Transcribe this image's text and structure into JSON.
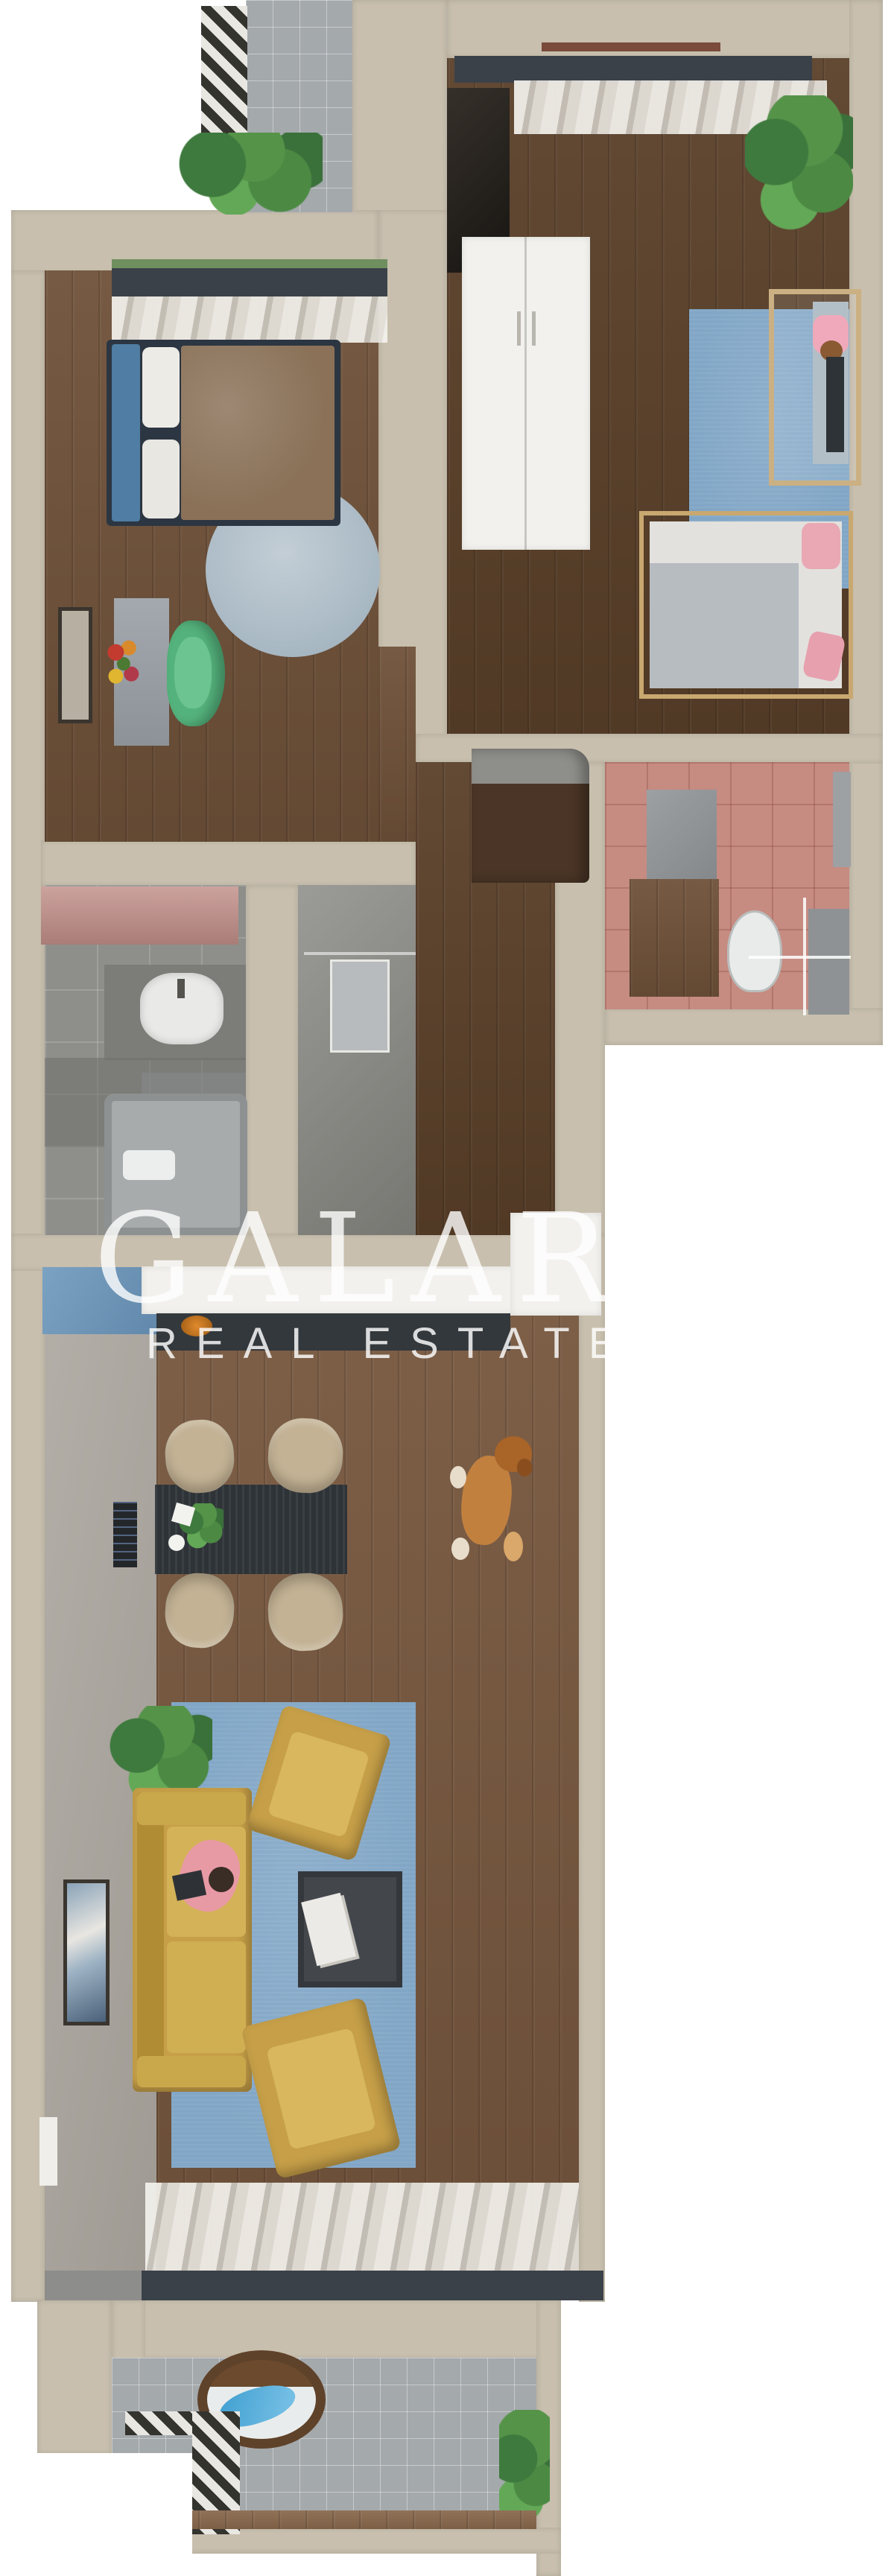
{
  "watermark": {
    "brand": "GALARDO",
    "tagline": "REAL ESTATE"
  },
  "palette": {
    "background": "#ffffff",
    "wall_beige": "#c8bfae",
    "wood_floor": "#6f5139",
    "wood_floor_dark": "#5a4029",
    "tile_gray": "#a4a9ac",
    "bathroom_pink": "#c68b81",
    "rug_blue": "#81a6c6",
    "sofa_mustard": "#c69f48",
    "window_frame_dark": "#3a4149",
    "chair_green": "#54b27c",
    "bench_pink": "#c18e88",
    "watermark_white": "rgba(255,255,255,0.8)"
  },
  "floor_plan": {
    "view": "3d-top-down-apartment-render",
    "rooms": [
      {
        "name": "top-balcony",
        "items": [
          "striped-rug",
          "plant"
        ]
      },
      {
        "name": "kids-bedroom",
        "items": [
          "window-curtains",
          "dark-cabinet",
          "white-wardrobe",
          "plant",
          "blue-rug",
          "standing-mirror",
          "canopy-bed",
          "pink-pillows"
        ]
      },
      {
        "name": "master-bedroom",
        "items": [
          "window-curtains",
          "double-bed",
          "round-rug",
          "desk",
          "flowers",
          "green-chair",
          "wall-art",
          "pink-bench"
        ]
      },
      {
        "name": "pink-bathroom",
        "items": [
          "vanity",
          "toilet",
          "shower-glass",
          "cabinet"
        ]
      },
      {
        "name": "hallway",
        "items": [
          "dark-wardrobe",
          "mirror-closet"
        ]
      },
      {
        "name": "small-bathroom",
        "items": [
          "sink",
          "vanity",
          "bathtub"
        ]
      },
      {
        "name": "kitchen-living-room",
        "items": [
          "blue-island",
          "white-counter",
          "fridge",
          "cooktop-pot",
          "dining-table",
          "dining-chairs",
          "sideboard",
          "dog",
          "blue-rug",
          "sofa",
          "person-reading",
          "armchairs",
          "coffee-table",
          "wall-art",
          "window-curtains"
        ]
      },
      {
        "name": "bottom-balcony",
        "items": [
          "hanging-egg-chair",
          "striped-rug",
          "plant"
        ]
      }
    ]
  }
}
